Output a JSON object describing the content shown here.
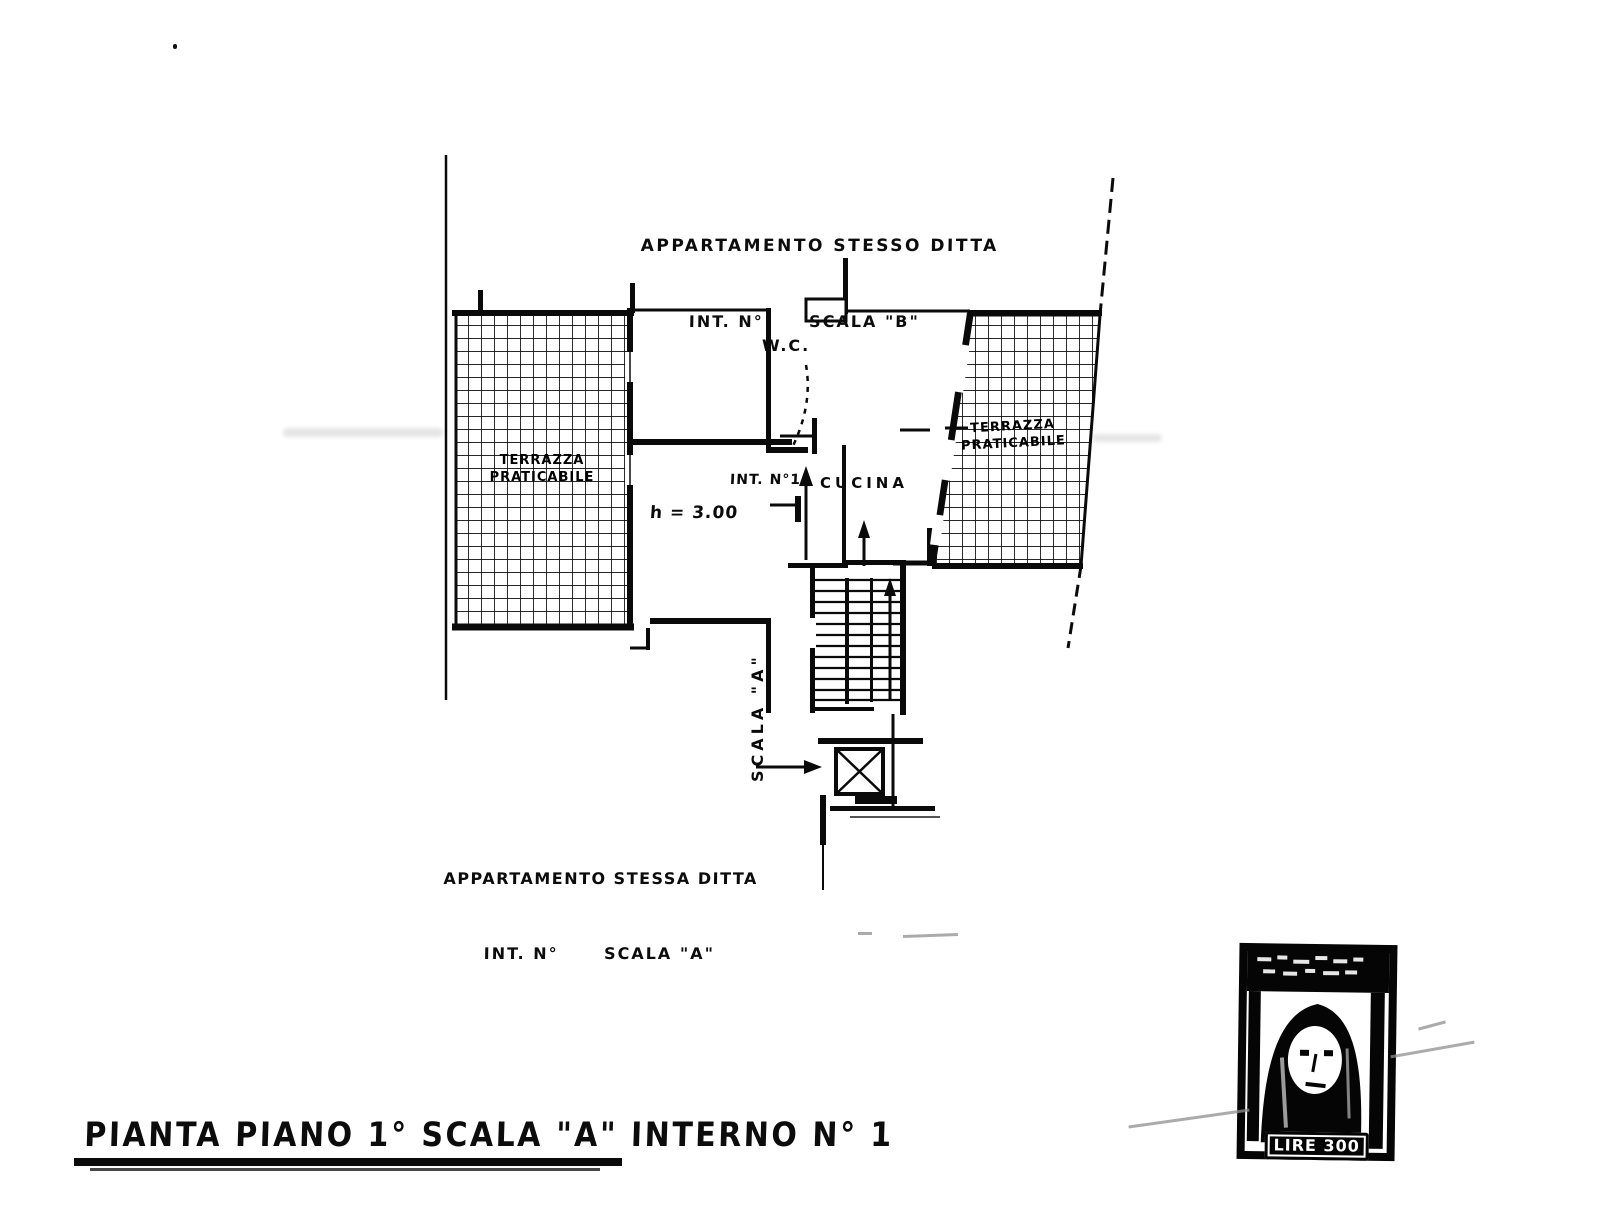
{
  "page": {
    "background_color": "#ffffff",
    "ink_color": "#0b0b0b",
    "kind": "scanned architectural floor plan"
  },
  "annotations": {
    "top_note_line1": "APPARTAMENTO STESSO DITTA",
    "top_note_line2": "INT. N°      SCALA \"B\"",
    "bottom_note_line1": "APPARTAMENTO STESSA DITTA",
    "bottom_note_line2": "INT. N°      SCALA \"A\"",
    "title": "PIANTA PIANO 1° SCALA \"A\" INTERNO N° 1"
  },
  "plan_labels": {
    "wc": "W.C.",
    "interno": "INT. N°1",
    "kitchen": "CUCINA",
    "room_height": "h = 3.00",
    "stair": "SCALA \"A\"",
    "terrace_left_line1": "TERRAZZA",
    "terrace_left_line2": "PRATICABILE",
    "terrace_right_line1": "TERRAZZA",
    "terrace_right_line2": "PRATICABILE"
  },
  "stamp": {
    "value_label": "LIRE 300"
  }
}
